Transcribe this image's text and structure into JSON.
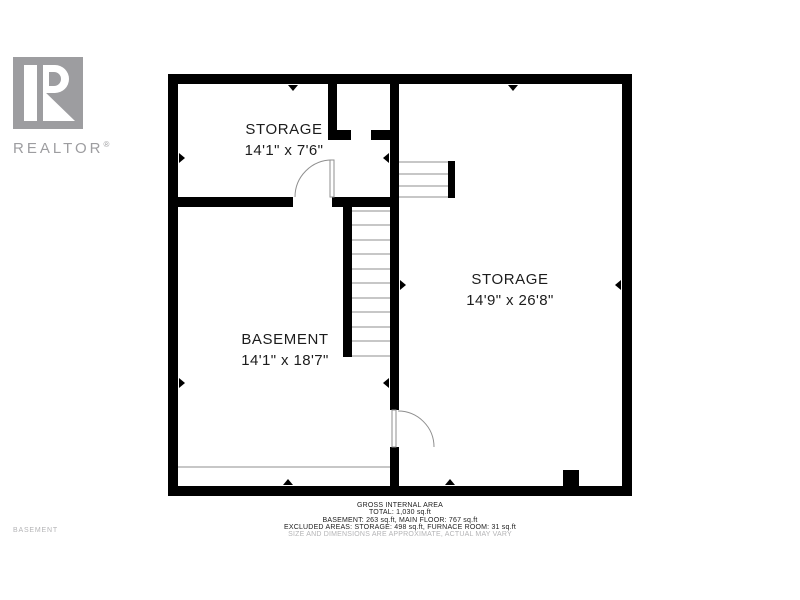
{
  "colors": {
    "wall": "#000000",
    "logo_gray": "#9d9da0",
    "muted": "#b4b4b6",
    "thin_line": "#8f8f8f",
    "text": "#1c1c1c"
  },
  "branding": {
    "logo_text": "REALTOR",
    "logo_reg": "®"
  },
  "floor_label": "BASEMENT",
  "rooms": [
    {
      "name": "STORAGE",
      "dims": "14'1\" x 7'6\""
    },
    {
      "name": "STORAGE",
      "dims": "14'9\" x 26'8\""
    },
    {
      "name": "BASEMENT",
      "dims": "14'1\" x 18'7\""
    }
  ],
  "footer": {
    "lines": [
      "GROSS INTERNAL AREA",
      "TOTAL: 1,030 sq.ft",
      "BASEMENT: 263 sq.ft, MAIN FLOOR: 767 sq.ft",
      "EXCLUDED AREAS: STORAGE: 498 sq.ft, FURNACE ROOM: 31 sq.ft",
      "SIZE AND DIMENSIONS ARE APPROXIMATE, ACTUAL MAY VARY"
    ]
  }
}
